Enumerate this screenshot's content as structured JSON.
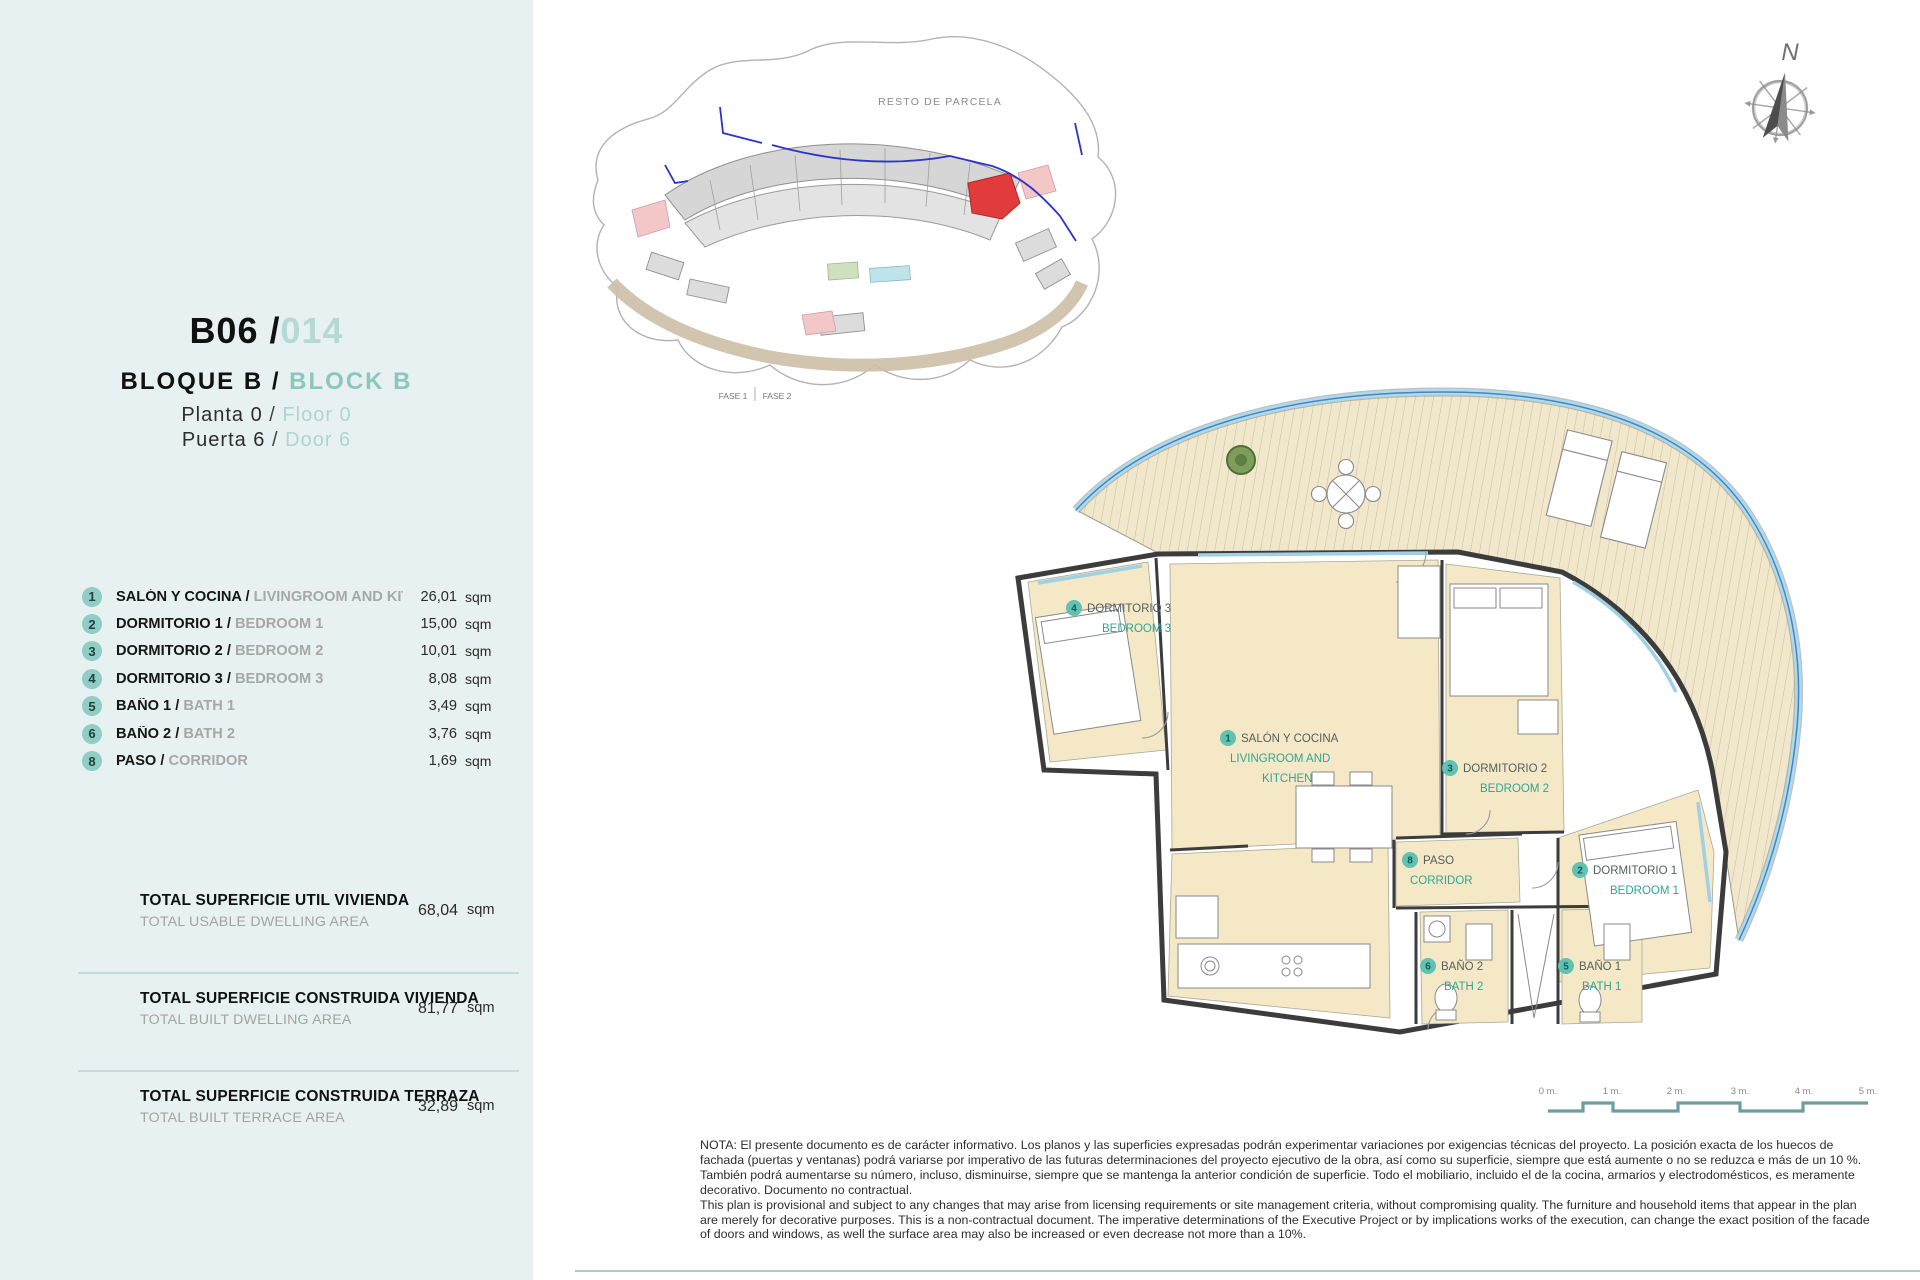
{
  "panel": {
    "unit": {
      "code": "B06 /",
      "number": "014"
    },
    "block": {
      "es": "BLOQUE B",
      "sep": "/",
      "en": "BLOCK B"
    },
    "floor": {
      "es": "Planta 0",
      "sep": "/",
      "en": "Floor 0"
    },
    "door": {
      "es": "Puerta 6",
      "sep": "/",
      "en": "Door 6"
    },
    "rooms": [
      {
        "num": "1",
        "name_es": "SALÓN Y COCINA / ",
        "name_en": "LIVINGROOM AND KITCHEN",
        "area": "26,01",
        "unit": "sqm"
      },
      {
        "num": "2",
        "name_es": "DORMITORIO 1 / ",
        "name_en": "BEDROOM 1",
        "area": "15,00",
        "unit": "sqm"
      },
      {
        "num": "3",
        "name_es": "DORMITORIO 2 / ",
        "name_en": "BEDROOM 2",
        "area": "10,01",
        "unit": "sqm"
      },
      {
        "num": "4",
        "name_es": "DORMITORIO 3 / ",
        "name_en": "BEDROOM 3",
        "area": "8,08",
        "unit": "sqm"
      },
      {
        "num": "5",
        "name_es": "BAÑO 1 / ",
        "name_en": "BATH 1",
        "area": "3,49",
        "unit": "sqm"
      },
      {
        "num": "6",
        "name_es": "BAÑO 2 / ",
        "name_en": "BATH 2",
        "area": "3,76",
        "unit": "sqm"
      },
      {
        "num": "8",
        "name_es": "PASO / ",
        "name_en": "CORRIDOR",
        "area": "1,69",
        "unit": "sqm"
      }
    ],
    "totals": [
      {
        "label_es": "TOTAL SUPERFICIE UTIL VIVIENDA",
        "label_en": "TOTAL USABLE DWELLING AREA",
        "value": "68,04",
        "unit": "sqm"
      },
      {
        "label_es": "TOTAL SUPERFICIE CONSTRUIDA VIVIENDA",
        "label_en": "TOTAL BUILT DWELLING AREA",
        "value": "81,77",
        "unit": "sqm"
      },
      {
        "label_es": "TOTAL SUPERFICIE CONSTRUIDA TERRAZA",
        "label_en": "TOTAL BUILT TERRACE AREA",
        "value": "32,89",
        "unit": "sqm"
      }
    ]
  },
  "site_plan": {
    "parcel_label": "RESTO DE PARCELA",
    "phase1": "FASE 1",
    "phase2": "FASE 2"
  },
  "compass": {
    "north": "N"
  },
  "floor_plan": {
    "rooms": [
      {
        "num": "4",
        "name_es": "DORMITORIO 3",
        "name_en": "BEDROOM 3"
      },
      {
        "num": "1",
        "name_es": "SALÓN Y COCINA",
        "name_en_l1": "LIVINGROOM AND",
        "name_en_l2": "KITCHEN"
      },
      {
        "num": "3",
        "name_es": "DORMITORIO 2",
        "name_en": "BEDROOM 2"
      },
      {
        "num": "8",
        "name_es": "PASO",
        "name_en": "CORRIDOR"
      },
      {
        "num": "2",
        "name_es": "DORMITORIO 1",
        "name_en": "BEDROOM 1"
      },
      {
        "num": "6",
        "name_es": "BAÑO 2",
        "name_en": "BATH 2"
      },
      {
        "num": "5",
        "name_es": "BAÑO 1",
        "name_en": "BATH 1"
      }
    ]
  },
  "scale_bar": {
    "ticks": [
      "0 m.",
      "1 m.",
      "2 m.",
      "3 m.",
      "4 m.",
      "5 m."
    ]
  },
  "note": {
    "es": "NOTA: El presente documento es de carácter informativo. Los planos y las superficies expresadas podrán experimentar variaciones por exigencias técnicas del proyecto. La posición exacta de los huecos de fachada (puertas y ventanas) podrá variarse por imperativo de las futuras determinaciones del proyecto ejecutivo de la obra, así como su superficie, siempre que está aumente o no se reduzca e más de un 10 %. También podrá aumentarse su número, incluso, disminuirse, siempre que se mantenga la anterior condición de superficie. Todo el mobiliario, incluido el de la cocina, armarios y electrodomésticos, es meramente decorativo. Documento no contractual.",
    "en": "This plan is provisional and subject to any changes that may arise from licensing requirements or site management criteria, without compromising quality. The furniture and household items that appear in the plan are merely for decorative purposes. This is a non-contractual document. The imperative determinations of the Executive Project or by implications works of the execution, can change the exact position of the facade of doors and windows, as well the surface area may also be increased or even decrease not more than a 10%."
  },
  "colors": {
    "panel_bg": "#e8f1f1",
    "accent_teal": "#8fcdc5",
    "pale_teal": "#b5dad3",
    "plan_label_teal": "#2fa795",
    "room_fill": "#f4e8c6",
    "deck_stripe": "#cdbf97",
    "water_blue": "#abdcee",
    "line_blue": "#4d82bd",
    "red_unit": "#e23b3c"
  }
}
